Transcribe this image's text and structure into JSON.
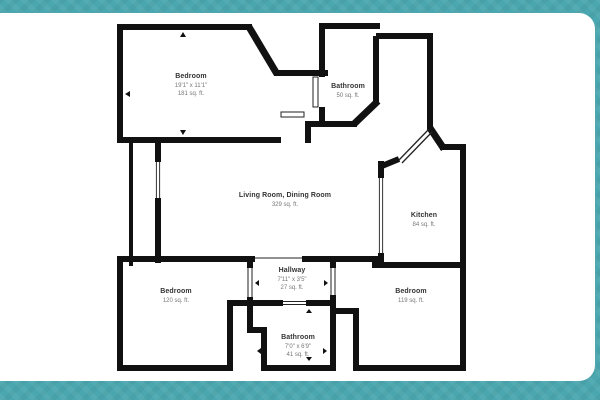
{
  "title": "Floor plan",
  "colors": {
    "frame_teal": "#4BA7AF",
    "wall_black": "#111111",
    "floor_white": "#FFFFFF",
    "label_gray": "#777777"
  },
  "icons": {
    "dimension_arrow": "small solid triangle marker on dimensioned walls",
    "door_leaf": "thin parallel-line door panel in wall gaps",
    "window": "thin double line in wall gap"
  },
  "rooms": [
    {
      "id": "bedroom-top",
      "name": "Bedroom",
      "dims": "19'1\" x 11'1\"",
      "area": "181 sq. ft."
    },
    {
      "id": "bathroom-top",
      "name": "Bathroom",
      "dims": "",
      "area": "50 sq. ft."
    },
    {
      "id": "living-dining",
      "name": "Living Room, Dining Room",
      "dims": "",
      "area": "329 sq. ft."
    },
    {
      "id": "kitchen",
      "name": "Kitchen",
      "dims": "",
      "area": "84 sq. ft."
    },
    {
      "id": "hallway",
      "name": "Hallway",
      "dims": "7'11\" x 3'5\"",
      "area": "27 sq. ft."
    },
    {
      "id": "bedroom-left",
      "name": "Bedroom",
      "dims": "",
      "area": "120 sq. ft."
    },
    {
      "id": "bathroom-bottom",
      "name": "Bathroom",
      "dims": "7'0\" x 6'9\"",
      "area": "41 sq. ft."
    },
    {
      "id": "bedroom-right",
      "name": "Bedroom",
      "dims": "",
      "area": "119 sq. ft."
    }
  ]
}
